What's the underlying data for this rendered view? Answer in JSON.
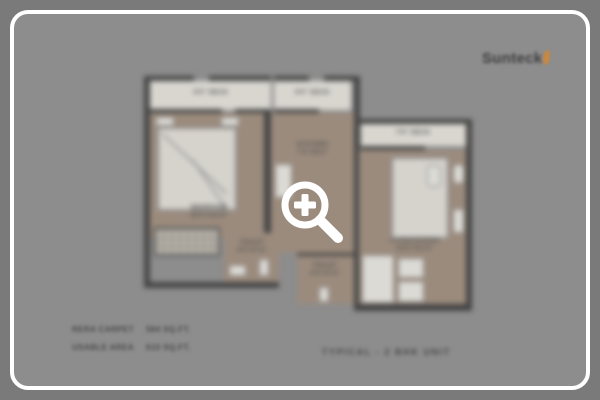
{
  "brand": {
    "name": "Sunteck",
    "accent_color": "#d9862c"
  },
  "overlay": {
    "zoom_icon": "magnifier-plus-icon",
    "icon_color": "#ffffff"
  },
  "plan": {
    "caption": "TYPICAL - 2 BHK UNIT",
    "labels": {
      "deck1": "8'0\" DECK",
      "deck2": "8'0\" DECK",
      "deck3": "7'6\" DECK",
      "bedroom1_name": "BEDROOM",
      "bedroom1_dim": "10'0\"X11'6\"",
      "kitchen_name": "KITCHEN",
      "kitchen_dim": "7'6\"X8'0\"",
      "living_name": "LIVING/DINING",
      "living_dim": "10'6\"X11'0\"",
      "toilet1_name": "TOILET",
      "toilet1_dim": "4'0\"X7'6\"",
      "toilet2_name": "TOILET",
      "toilet2_dim": "4'0\"X7'6\""
    }
  },
  "area_table": {
    "rows": [
      {
        "label": "RERA CARPET",
        "value": "584 SQ.FT."
      },
      {
        "label": "USABLE AREA",
        "value": "610 SQ.FT."
      }
    ]
  },
  "colors": {
    "page_background": "#7a7a7a",
    "card_background": "#8d8d8d",
    "card_border": "#ffffff",
    "plan_floor": "#9b8b7d",
    "plan_walls": "#454545",
    "plan_light_rooms": "#d9d6d0"
  }
}
